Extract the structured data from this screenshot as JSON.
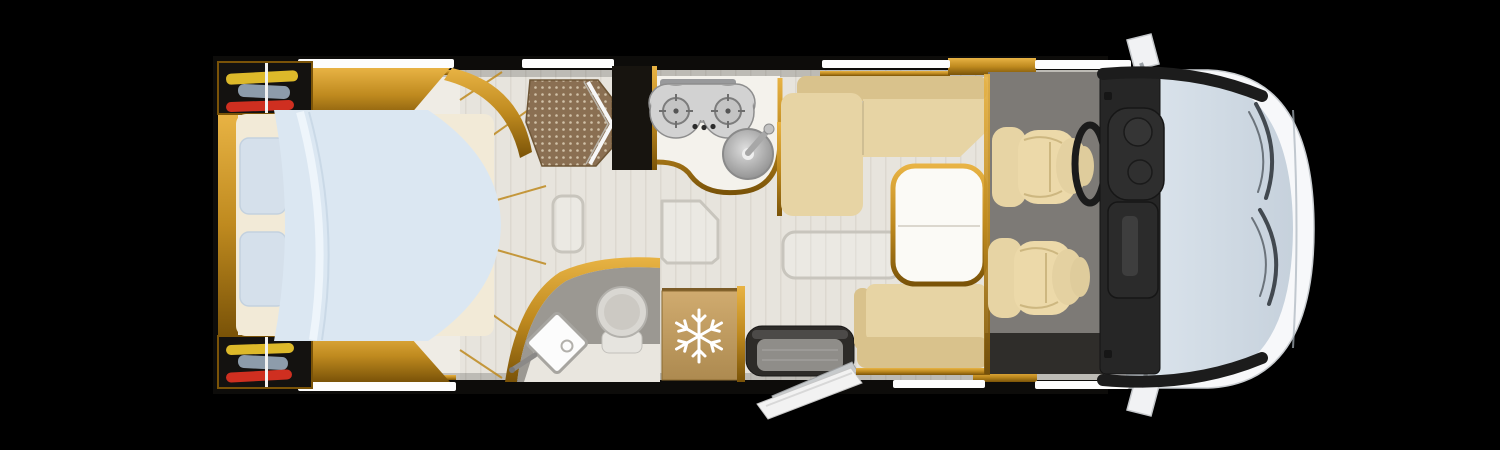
{
  "scene": {
    "type": "motorhome-floor-plan-top-view",
    "orientation": "front-of-vehicle-right",
    "background": "#000000"
  },
  "colors": {
    "bg": "#000000",
    "wall": "#0d0c0a",
    "gold": "#bf8a1f",
    "goldHi": "#e8b344",
    "goldDeep": "#7a5308",
    "floor": "#e7e4dd",
    "plank": "#d2cec4",
    "panel": "#efece5",
    "sheet": "#f2ead7",
    "duvet": "#dbe7f2",
    "duvetHi": "#eef5fb",
    "pillow": "#d5e0eb",
    "sofa": "#e7d4a4",
    "sofaDark": "#d9c28c",
    "seatBeige": "#ecd9a9",
    "carpet": "#7d7a76",
    "carpetDark": "#2f2d2a",
    "tile": "#8a6f52",
    "tileDot": "#dccfb6",
    "counter": "#f4f2ec",
    "steel": "#c9c9c9",
    "steelDark": "#8a8a8a",
    "batFloor": "#9b9892",
    "fridge": "#d0ab6f",
    "fridgeDark": "#ad8a50",
    "dash": "#262626",
    "dashHi": "#3e3e3e",
    "cabBody": "#f7f8fa",
    "glass": "#dde6ee",
    "glassDeep": "#c6d1dc",
    "windowStrip": "#fdfdfd",
    "clothesYellow": "#ddb92a",
    "clothesBlue": "#8d9cab",
    "clothesRed": "#cf2f20",
    "toiletBowl": "#d9d7d2",
    "darkCabinet": "#17140f",
    "stepFrame": "#2d2b28",
    "stepMat": "#8f8d89",
    "doorWhite": "#f2f2f2"
  },
  "vehicle": {
    "areas": [
      {
        "name": "bedroom",
        "features": [
          "double-bed",
          "duvet",
          "pillows-2",
          "wardrobe-with-clothes-top",
          "wardrobe-with-clothes-bottom"
        ]
      },
      {
        "name": "shower-room",
        "features": [
          "shower-tray-tiled",
          "bifold-glass-door",
          "tall-dark-cabinet"
        ]
      },
      {
        "name": "kitchen",
        "features": [
          "countertop",
          "gas-hob-2-burner",
          "control-knobs-3",
          "round-sink",
          "faucet"
        ]
      },
      {
        "name": "washroom",
        "features": [
          "toilet",
          "corner-washbasin",
          "basin-faucet"
        ]
      },
      {
        "name": "refrigerator",
        "features": [
          "snowflake-icon"
        ]
      },
      {
        "name": "entrance",
        "features": [
          "entry-step-well",
          "door-open-outward"
        ]
      },
      {
        "name": "lounge",
        "features": [
          "l-shaped-sofa",
          "bench-seat",
          "dinette-table",
          "floor-hatch-1",
          "floor-hatch-2",
          "floor-hatch-3"
        ]
      },
      {
        "name": "cab",
        "features": [
          "carpet",
          "driver-swivel-seat",
          "passenger-swivel-seat",
          "steering-wheel",
          "dashboard",
          "windshield",
          "wiper-upper",
          "wiper-lower",
          "side-mirror-top",
          "side-mirror-bottom"
        ]
      }
    ],
    "window_strips_top": 4,
    "window_strips_bottom": 3,
    "hob_burners": 2,
    "swivel_seats": 2,
    "floor_hatches": 3
  },
  "icons": {
    "fridge_symbol": "snowflake-icon"
  }
}
